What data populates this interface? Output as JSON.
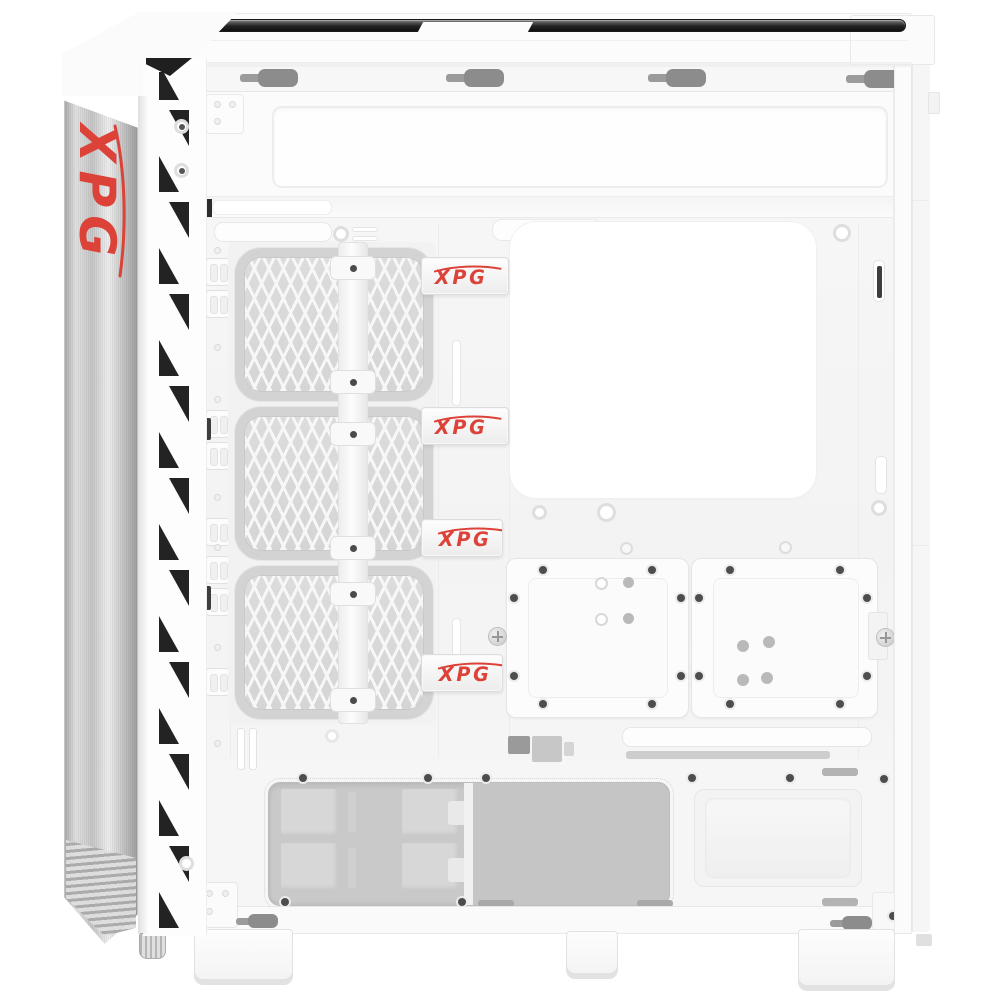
{
  "branding": {
    "front_panel_logo": "XPG",
    "cable_straps": [
      "XPG",
      "XPG",
      "XPG",
      "XPG"
    ]
  },
  "colors": {
    "accent_red": "#DC4238",
    "chassis_white": "#FAFAFA",
    "interior_recess_gray": "#C9C9C9",
    "fan_mesh_gray": "#DADADA",
    "keyhole_slot_gray": "#8C8C8C",
    "top_trim_dark": "#2E2E2E",
    "vent_cutout_black": "#232323",
    "brushed_aluminum_gray": "#CFCFCF"
  }
}
